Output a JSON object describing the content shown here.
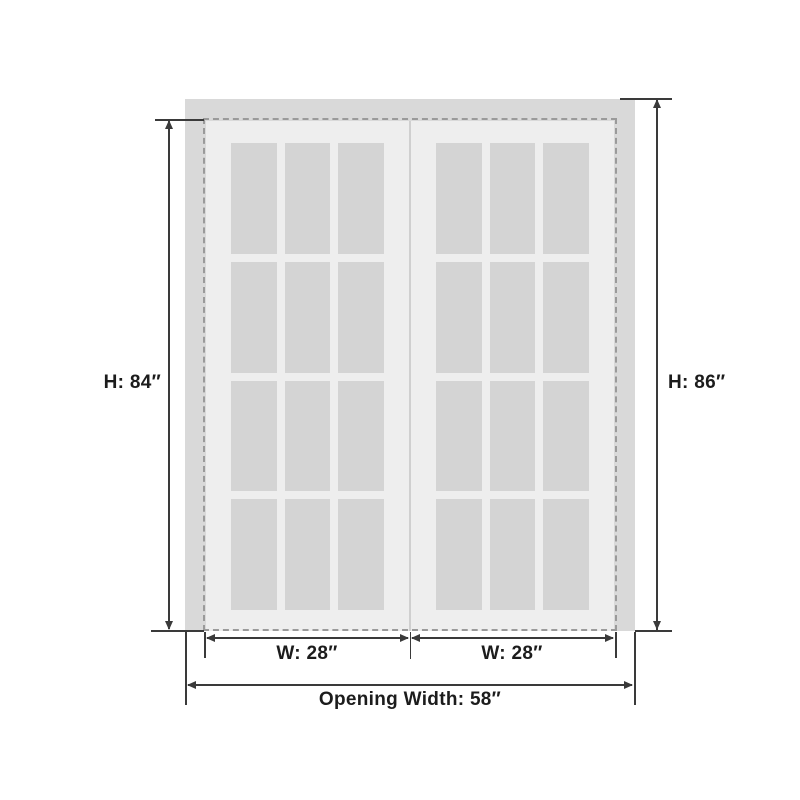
{
  "diagram": {
    "type": "double-door-dimension-diagram",
    "labels": {
      "door_height": "H: 84″",
      "opening_height": "H: 86″",
      "left_door_width": "W: 28″",
      "right_door_width": "W: 28″",
      "opening_width": "Opening Width: 58″"
    },
    "values": {
      "door_height_in": 84,
      "opening_height_in": 86,
      "door_width_in": 28,
      "opening_width_in": 58
    },
    "structure": {
      "door_count": 2,
      "panes_per_door": 12,
      "pane_grid": "3 columns x 4 rows"
    },
    "colors": {
      "background": "#ffffff",
      "frame": "#d9d9d9",
      "door": "#eeeeee",
      "glass": "#d4d4d4",
      "dashed_outline": "#9a9a9a",
      "dimension_line": "#3a3a3a",
      "label_text": "#1c1c1c"
    }
  }
}
